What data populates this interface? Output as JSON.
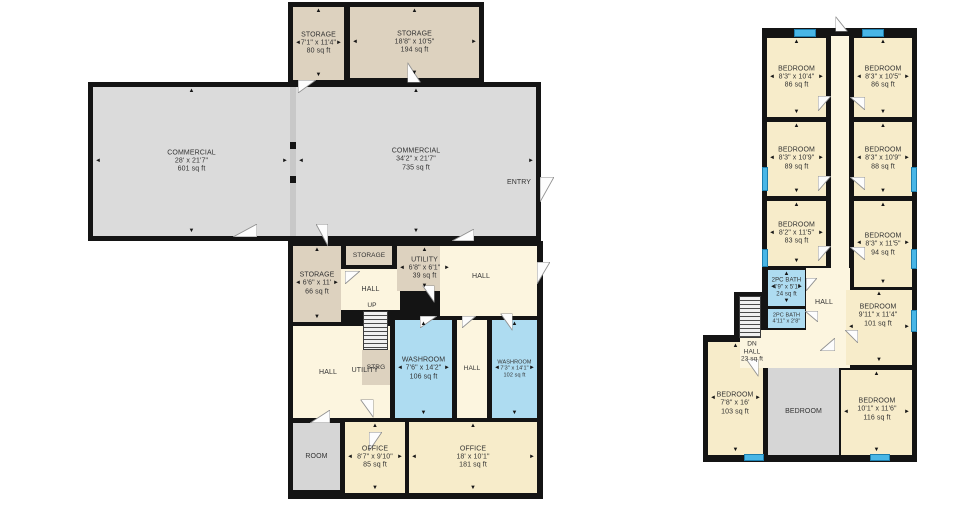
{
  "title": "Floor Plan",
  "colors": {
    "wall": "#141414",
    "tan": "#ddd2bf",
    "beige": "#f7ecca",
    "cream": "#fcf5df",
    "blue": "#aedcf1",
    "grey": "#dbdbdb",
    "grey2": "#d6d6d6",
    "window": "#49b6e6",
    "divider": "#c8c8c8",
    "text": "#333333"
  },
  "plans": [
    {
      "name": "main-floor",
      "blocks": [
        {
          "x": 288,
          "y": 2,
          "w": 196,
          "h": 86
        },
        {
          "x": 88,
          "y": 82,
          "w": 453,
          "h": 159
        },
        {
          "x": 288,
          "y": 241,
          "w": 255,
          "h": 258
        }
      ],
      "fills": [
        {
          "x": 290,
          "y": 87,
          "w": 6,
          "h": 149,
          "c": "#c8c8c8"
        },
        {
          "x": 288,
          "y": 142,
          "w": 9,
          "h": 7,
          "c": "#141414"
        },
        {
          "x": 288,
          "y": 176,
          "w": 9,
          "h": 7,
          "c": "#141414"
        }
      ],
      "rooms": [
        {
          "n": "storage-a",
          "x": 293,
          "y": 7,
          "w": 51,
          "h": 73,
          "c": "tan",
          "lines": [
            "STORAGE",
            "7'1\" x 11'4\"",
            "80 sq ft"
          ],
          "arrows": true
        },
        {
          "n": "storage-b",
          "x": 350,
          "y": 7,
          "w": 129,
          "h": 71,
          "c": "tan",
          "lines": [
            "STORAGE",
            "18'8\" x 10'5\"",
            "194 sq ft"
          ],
          "arrows": true
        },
        {
          "n": "commercial-left",
          "x": 93,
          "y": 87,
          "w": 197,
          "h": 149,
          "c": "grey",
          "lines": [
            "COMMERCIAL",
            "28' x 21'7\"",
            "601 sq ft"
          ],
          "arrows": true
        },
        {
          "n": "commercial-right",
          "x": 296,
          "y": 87,
          "w": 240,
          "h": 149,
          "c": "grey",
          "lines": [
            "COMMERCIAL",
            "34'2\" x 21'7\"",
            "735 sq ft"
          ],
          "arrows": true,
          "lx": 416,
          "ly": 160
        },
        {
          "n": "storage-c",
          "x": 293,
          "y": 246,
          "w": 48,
          "h": 76,
          "c": "tan",
          "lines": [
            "STORAGE",
            "6'6\" x 11'",
            "66 sq ft"
          ],
          "arrows": true
        },
        {
          "n": "storage-d",
          "x": 346,
          "y": 246,
          "w": 46,
          "h": 19,
          "c": "tan",
          "lines": [
            "STORAGE"
          ],
          "fs": 6.5
        },
        {
          "n": "hall-a",
          "x": 341,
          "y": 269,
          "w": 59,
          "h": 41,
          "c": "cream",
          "lines": [
            "HALL"
          ]
        },
        {
          "n": "utility-a",
          "x": 397,
          "y": 246,
          "w": 55,
          "h": 45,
          "c": "tan",
          "lines": [
            "UTILITY",
            "6'8\" x 6'1\"",
            "39 sq ft"
          ],
          "arrows": true
        },
        {
          "n": "hall-b",
          "x": 440,
          "y": 246,
          "w": 97,
          "h": 70,
          "c": "cream",
          "lines": [
            "HALL"
          ],
          "lx": 481,
          "ly": 277
        },
        {
          "n": "hall-utility",
          "x": 293,
          "y": 326,
          "w": 97,
          "h": 92,
          "c": "cream",
          "lines": []
        },
        {
          "n": "strg",
          "x": 362,
          "y": 350,
          "w": 28,
          "h": 35,
          "c": "tan",
          "lines": [
            "STRG"
          ],
          "fs": 6.5
        },
        {
          "n": "washroom-a",
          "x": 395,
          "y": 320,
          "w": 57,
          "h": 98,
          "c": "blue",
          "lines": [
            "WASHROOM",
            "7'6\" x 14'2\"",
            "106 sq ft"
          ],
          "arrows": true
        },
        {
          "n": "hall-c",
          "x": 457,
          "y": 320,
          "w": 30,
          "h": 98,
          "c": "cream",
          "lines": [
            "HALL"
          ],
          "fs": 6.5
        },
        {
          "n": "washroom-b",
          "x": 492,
          "y": 320,
          "w": 45,
          "h": 98,
          "c": "blue",
          "lines": [
            "WASHROOM",
            "7'3\" x 14'1\"",
            "102 sq ft"
          ],
          "fs": 5.5,
          "arrows": true
        },
        {
          "n": "room-a",
          "x": 293,
          "y": 423,
          "w": 47,
          "h": 67,
          "c": "grey2",
          "lines": [
            "ROOM"
          ]
        },
        {
          "n": "office-a",
          "x": 345,
          "y": 422,
          "w": 60,
          "h": 71,
          "c": "beige",
          "lines": [
            "OFFICE",
            "8'7\" x 9'10\"",
            "85 sq ft"
          ],
          "arrows": true
        },
        {
          "n": "office-b",
          "x": 409,
          "y": 422,
          "w": 128,
          "h": 71,
          "c": "beige",
          "lines": [
            "OFFICE",
            "18' x 10'1\"",
            "181 sq ft"
          ],
          "arrows": true
        }
      ],
      "stairs": [
        {
          "x": 363,
          "y": 311,
          "w": 25,
          "h": 39
        }
      ],
      "windows": [],
      "doors": [
        {
          "x": 298,
          "y": 80,
          "w": 18,
          "h": 13,
          "r": 0
        },
        {
          "x": 404,
          "y": 66,
          "w": 20,
          "h": 13,
          "r": 270
        },
        {
          "x": 233,
          "y": 224,
          "w": 24,
          "h": 13,
          "r": 180
        },
        {
          "x": 540,
          "y": 177,
          "w": 14,
          "h": 25,
          "r": 0
        },
        {
          "x": 311,
          "y": 229,
          "w": 22,
          "h": 12,
          "r": 90
        },
        {
          "x": 452,
          "y": 229,
          "w": 22,
          "h": 12,
          "r": 180
        },
        {
          "x": 345,
          "y": 271,
          "w": 15,
          "h": 13,
          "r": 0
        },
        {
          "x": 420,
          "y": 288,
          "w": 17,
          "h": 12,
          "r": 90
        },
        {
          "x": 537,
          "y": 262,
          "w": 13,
          "h": 22,
          "r": 0
        },
        {
          "x": 420,
          "y": 316,
          "w": 17,
          "h": 12,
          "r": 0
        },
        {
          "x": 498,
          "y": 316,
          "w": 17,
          "h": 12,
          "r": 90
        },
        {
          "x": 462,
          "y": 316,
          "w": 14,
          "h": 12,
          "r": 0
        },
        {
          "x": 310,
          "y": 410,
          "w": 20,
          "h": 13,
          "r": 180
        },
        {
          "x": 358,
          "y": 402,
          "w": 18,
          "h": 13,
          "r": 90
        },
        {
          "x": 369,
          "y": 432,
          "w": 13,
          "h": 19,
          "r": 0
        }
      ],
      "texts": [
        {
          "n": "entry-label",
          "x": 519,
          "y": 183,
          "lines": [
            "ENTRY"
          ]
        },
        {
          "n": "up-label",
          "x": 372,
          "y": 306,
          "lines": [
            "UP"
          ],
          "fs": 6.5
        },
        {
          "n": "hall-label",
          "x": 328,
          "y": 373,
          "lines": [
            "HALL"
          ]
        },
        {
          "n": "utility-label",
          "x": 365,
          "y": 371,
          "lines": [
            "UTILITY"
          ]
        }
      ]
    },
    {
      "name": "second-floor",
      "blocks": [
        {
          "x": 762,
          "y": 28,
          "w": 155,
          "h": 315
        },
        {
          "x": 734,
          "y": 292,
          "w": 34,
          "h": 52
        },
        {
          "x": 703,
          "y": 335,
          "w": 214,
          "h": 127
        }
      ],
      "fills": [],
      "rooms": [
        {
          "n": "corridor",
          "x": 831,
          "y": 36,
          "w": 18,
          "h": 232,
          "c": "cream",
          "lines": []
        },
        {
          "n": "bedroom-1l",
          "x": 767,
          "y": 38,
          "w": 59,
          "h": 79,
          "c": "beige",
          "lines": [
            "BEDROOM",
            "8'3\" x 10'4\"",
            "86 sq ft"
          ],
          "arrows": true
        },
        {
          "n": "bedroom-1r",
          "x": 854,
          "y": 38,
          "w": 58,
          "h": 79,
          "c": "beige",
          "lines": [
            "BEDROOM",
            "8'3\" x 10'5\"",
            "86 sq ft"
          ],
          "arrows": true
        },
        {
          "n": "bedroom-2l",
          "x": 767,
          "y": 122,
          "w": 59,
          "h": 74,
          "c": "beige",
          "lines": [
            "BEDROOM",
            "8'3\" x 10'9\"",
            "89 sq ft"
          ],
          "arrows": true
        },
        {
          "n": "bedroom-2r",
          "x": 854,
          "y": 122,
          "w": 58,
          "h": 74,
          "c": "beige",
          "lines": [
            "BEDROOM",
            "8'3\" x 10'9\"",
            "88 sq ft"
          ],
          "arrows": true
        },
        {
          "n": "bedroom-3l",
          "x": 767,
          "y": 201,
          "w": 59,
          "h": 65,
          "c": "beige",
          "lines": [
            "BEDROOM",
            "8'2\" x 11'5\"",
            "83 sq ft"
          ],
          "arrows": true
        },
        {
          "n": "bedroom-3r",
          "x": 854,
          "y": 201,
          "w": 58,
          "h": 86,
          "c": "beige",
          "lines": [
            "BEDROOM",
            "8'3\" x 11'5\"",
            "94 sq ft"
          ],
          "arrows": true,
          "lx": 883,
          "ly": 245
        },
        {
          "n": "bath-a",
          "x": 768,
          "y": 270,
          "w": 37,
          "h": 36,
          "c": "blue",
          "lines": [
            "2PC BATH",
            "4'9\" x 5'1\"",
            "24 sq ft"
          ],
          "fs": 6,
          "arrows": true
        },
        {
          "n": "bath-b",
          "x": 768,
          "y": 309,
          "w": 37,
          "h": 19,
          "c": "blue",
          "lines": [
            "2PC BATH",
            "4'11\" x 2'8\""
          ],
          "fs": 5.5
        },
        {
          "n": "hall-d",
          "x": 806,
          "y": 268,
          "w": 44,
          "h": 100,
          "c": "cream",
          "lines": [
            "HALL"
          ],
          "lx": 824,
          "ly": 303
        },
        {
          "n": "bedroom-bl",
          "x": 708,
          "y": 342,
          "w": 55,
          "h": 113,
          "c": "beige",
          "lines": [
            "BEDROOM",
            "7'8\" x 16'",
            "103 sq ft"
          ],
          "arrows": true,
          "lx": 735,
          "ly": 404
        },
        {
          "n": "hall-e",
          "x": 740,
          "y": 330,
          "w": 97,
          "h": 38,
          "c": "cream",
          "lines": []
        },
        {
          "n": "bedroom-mr",
          "x": 846,
          "y": 290,
          "w": 66,
          "h": 75,
          "c": "beige",
          "lines": [
            "BEDROOM",
            "9'11\" x 11'4\"",
            "101 sq ft"
          ],
          "arrows": true,
          "lx": 878,
          "ly": 316
        },
        {
          "n": "bedroom-bm",
          "x": 768,
          "y": 368,
          "w": 71,
          "h": 87,
          "c": "grey2",
          "lines": [
            "BEDROOM"
          ]
        },
        {
          "n": "bedroom-br",
          "x": 841,
          "y": 370,
          "w": 71,
          "h": 85,
          "c": "beige",
          "lines": [
            "BEDROOM",
            "10'1\" x 11'6\"",
            "116 sq ft"
          ],
          "arrows": true,
          "lx": 877,
          "ly": 410
        }
      ],
      "stairs": [
        {
          "x": 739,
          "y": 296,
          "w": 22,
          "h": 42
        }
      ],
      "windows": [
        {
          "x": 794,
          "y": 29,
          "w": 22,
          "h": 8
        },
        {
          "x": 862,
          "y": 29,
          "w": 22,
          "h": 8
        },
        {
          "x": 762,
          "y": 167,
          "w": 6,
          "h": 24
        },
        {
          "x": 762,
          "y": 249,
          "w": 6,
          "h": 18
        },
        {
          "x": 911,
          "y": 167,
          "w": 6,
          "h": 25
        },
        {
          "x": 911,
          "y": 249,
          "w": 6,
          "h": 20
        },
        {
          "x": 911,
          "y": 310,
          "w": 6,
          "h": 22
        },
        {
          "x": 744,
          "y": 454,
          "w": 20,
          "h": 7
        },
        {
          "x": 870,
          "y": 454,
          "w": 20,
          "h": 7
        }
      ],
      "doors": [
        {
          "x": 818,
          "y": 96,
          "w": 13,
          "h": 15,
          "r": 0
        },
        {
          "x": 851,
          "y": 96,
          "w": 13,
          "h": 15,
          "r": 90
        },
        {
          "x": 818,
          "y": 176,
          "w": 13,
          "h": 15,
          "r": 0
        },
        {
          "x": 851,
          "y": 176,
          "w": 13,
          "h": 15,
          "r": 90
        },
        {
          "x": 818,
          "y": 246,
          "w": 13,
          "h": 15,
          "r": 0
        },
        {
          "x": 851,
          "y": 246,
          "w": 13,
          "h": 15,
          "r": 90
        },
        {
          "x": 834,
          "y": 18,
          "w": 15,
          "h": 12,
          "r": 270
        },
        {
          "x": 806,
          "y": 278,
          "w": 11,
          "h": 13,
          "r": 0
        },
        {
          "x": 806,
          "y": 310,
          "w": 11,
          "h": 13,
          "r": 90
        },
        {
          "x": 820,
          "y": 338,
          "w": 15,
          "h": 13,
          "r": 180
        },
        {
          "x": 845,
          "y": 330,
          "w": 13,
          "h": 13,
          "r": 90
        },
        {
          "x": 744,
          "y": 362,
          "w": 17,
          "h": 12,
          "r": 90
        }
      ],
      "texts": [
        {
          "n": "dn-hall-label",
          "x": 752,
          "y": 352,
          "lines": [
            "DN",
            "HALL",
            "23 sq ft"
          ],
          "fs": 6.5
        }
      ]
    }
  ]
}
